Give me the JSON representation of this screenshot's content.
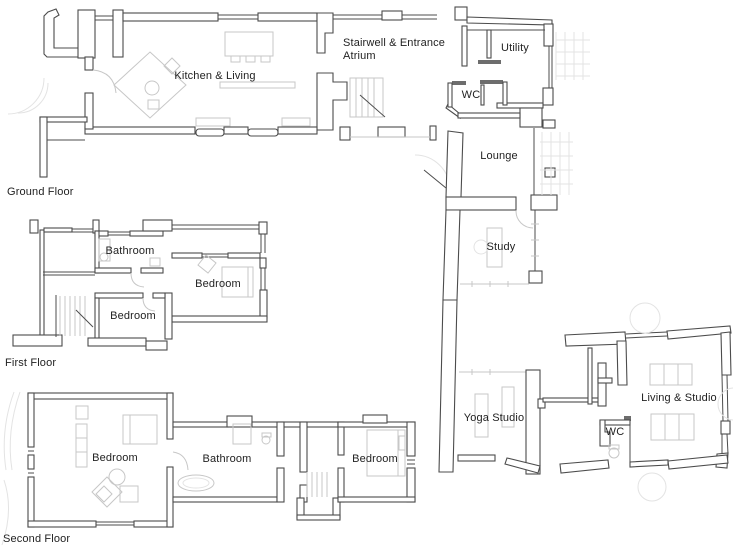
{
  "colors": {
    "wall": "#4c4c4c",
    "furniture": "#c7c7c7",
    "faint": "#e3e3e3",
    "text": "#222222",
    "background": "#ffffff"
  },
  "floors": {
    "ground": "Ground Floor",
    "first": "First Floor",
    "second": "Second Floor"
  },
  "rooms": {
    "kitchen_living": "Kitchen & Living",
    "stairwell_line1": "Stairwell & Entrance",
    "stairwell_line2": "Atrium",
    "utility": "Utility",
    "wc_ground": "WC",
    "lounge": "Lounge",
    "study": "Study",
    "yoga_studio": "Yoga Studio",
    "living_studio": "Living & Studio",
    "wc_studio": "WC",
    "first_bathroom": "Bathroom",
    "first_bedroom_main": "Bedroom",
    "first_bedroom_small": "Bedroom",
    "second_bedroom_left": "Bedroom",
    "second_bathroom": "Bathroom",
    "second_bedroom_right": "Bedroom"
  }
}
